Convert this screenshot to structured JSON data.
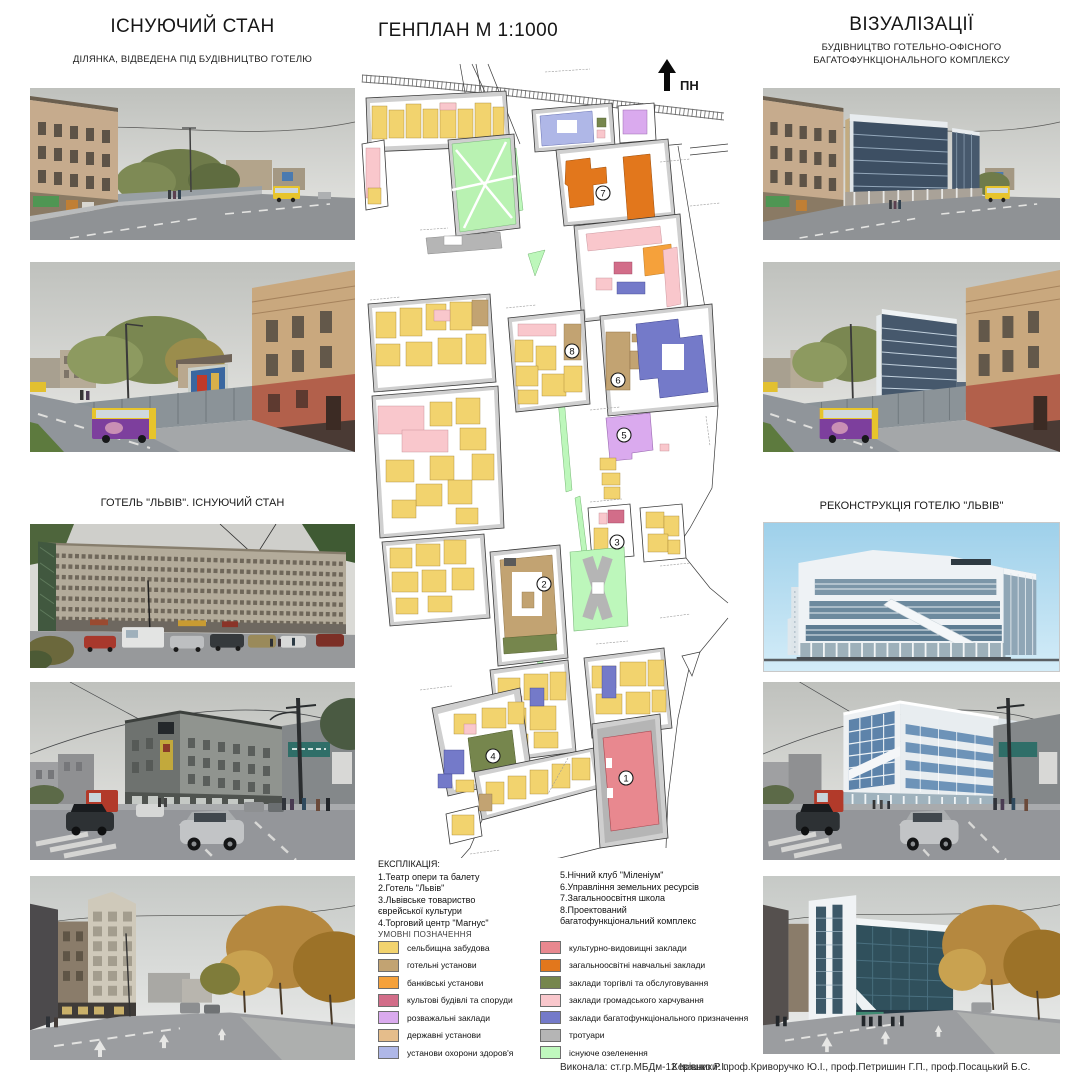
{
  "left_column": {
    "title": "ІСНУЮЧИЙ СТАН",
    "subtitle": "ДІЛЯНКА, ВІДВЕДЕНА ПІД БУДІВНИЦТВО ГОТЕЛЮ",
    "section2_label": "ГОТЕЛЬ \"ЛЬВІВ\". ІСНУЮЧИЙ СТАН"
  },
  "right_column": {
    "title": "ВІЗУАЛІЗАЦІЇ",
    "subtitle_line1": "БУДІВНИЦТВО ГОТЕЛЬНО-ОФІСНОГО",
    "subtitle_line2": "БАГАТОФУНКЦІОНАЛЬНОГО КОМПЛЕКСУ",
    "section2_label": "РЕКОНСТРУКЦІЯ ГОТЕЛЮ \"ЛЬВІВ\""
  },
  "center": {
    "title": "ГЕНПЛАН М 1:1000",
    "map": {
      "north": "ПН",
      "numbers": [
        "1",
        "2",
        "3",
        "4",
        "5",
        "6",
        "7",
        "8"
      ]
    },
    "explication": {
      "title": "ЕКСПЛІКАЦІЯ:",
      "col1": [
        "1.Театр опери та балету",
        "2.Готель \"Львів\"",
        "3.Львівське товариство єврейської культури",
        "4.Торговий центр \"Магнус\""
      ],
      "col2": [
        "5.Нічний клуб \"Міленіум\"",
        "6.Управління земельних ресурсів",
        "7.Загальноосвітня школа",
        "8.Проектований багатофункціональний комплекс"
      ]
    },
    "legend": {
      "title": "УМОВНІ ПОЗНАЧЕННЯ",
      "col1": [
        {
          "label": "сельбищна забудова",
          "color": "#F2D36E"
        },
        {
          "label": "готельні установи",
          "color": "#C2A372"
        },
        {
          "label": "банківські установи",
          "color": "#F5A13B"
        },
        {
          "label": "культові будівлі та споруди",
          "color": "#D26D89"
        },
        {
          "label": "розважальні заклади",
          "color": "#DAAAEE"
        },
        {
          "label": "державні установи",
          "color": "#E5BD8B"
        },
        {
          "label": "установи охорони здоров'я",
          "color": "#AFB7E7"
        }
      ],
      "col2": [
        {
          "label": "культурно-видовищні заклади",
          "color": "#E8888F"
        },
        {
          "label": "загальноосвітні навчальні заклади",
          "color": "#E2771C"
        },
        {
          "label": "заклади торгівлі та обслуговування",
          "color": "#76864D"
        },
        {
          "label": "заклади громадського харчування",
          "color": "#F9C7CC"
        },
        {
          "label": "заклади багатофункціонального призначення",
          "color": "#747AC9"
        },
        {
          "label": "тротуари",
          "color": "#B5B5B5"
        },
        {
          "label": "існуюче озеленення",
          "color": "#C0F8BE"
        }
      ]
    }
  },
  "footer": {
    "author": "Виконала: ст.гр.МБДм-12 Івашко Р.І.",
    "supervisors": "Керівники: проф.Криворучко Ю.І., проф.Петришин Г.П., проф.Посацький Б.С."
  }
}
